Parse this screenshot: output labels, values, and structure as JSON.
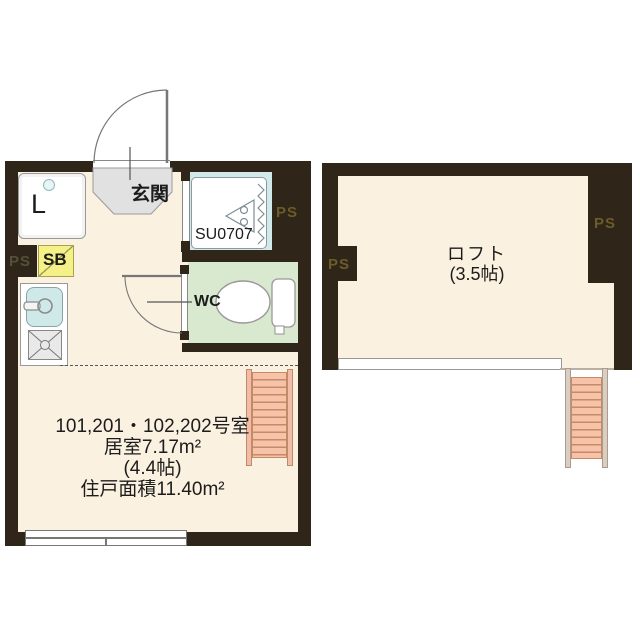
{
  "palette": {
    "wall": "#2f2518",
    "floor": "#fbf1e0",
    "entrance_gray": "#e1e1e1",
    "wc_green": "#d9e9cf",
    "bath_blue": "#d2e9ec",
    "sink_blue": "#cfe9e9",
    "shoebox_yellow": "#f5f087",
    "ladder_salmon": "#f6c3a8",
    "ps_text": "#6b5c2a"
  },
  "left_plan": {
    "entrance_label": "玄関",
    "laundry_label": "L",
    "shoebox_label": "SB",
    "unit_bath_label": "SU0707",
    "wc_label": "WC",
    "ps_left": "PS",
    "ps_right": "PS",
    "info_lines": [
      "101,201・102,202号室",
      "居室7.17m²",
      "(4.4帖)",
      "住戸面積11.40m²"
    ]
  },
  "right_plan": {
    "loft_label": "ロフト",
    "loft_size_label": "(3.5帖)",
    "ps_left": "PS",
    "ps_right": "PS"
  }
}
